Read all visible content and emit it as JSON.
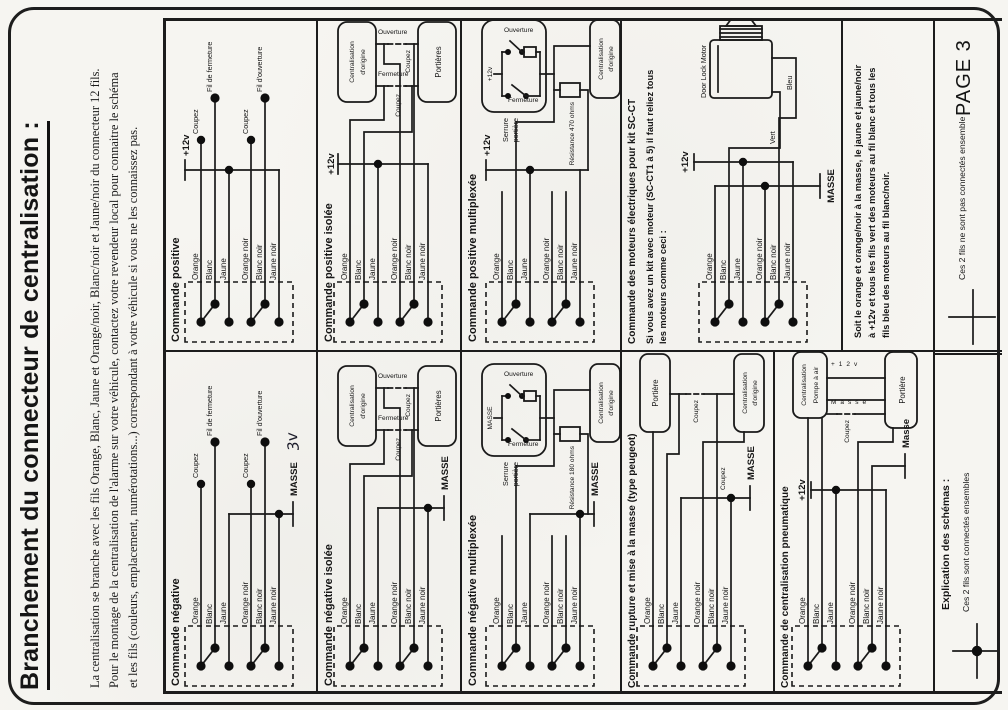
{
  "page": {
    "title": "Branchement du connecteur de centralisation :",
    "intro_lines": [
      "La centralisation se branche avec les fils Orange, Blanc, Jaune et Orange/noir, Blanc/noir et Jaune/noir du connecteur 12 fils.",
      "Pour le montage de la centralisation de l'alarme sur votre véhicule, contactez votre revendeur local pour connaitre le schéma",
      "et les fils (couleurs, emplacement, numérotations...) correspondant à votre véhicule si vous ne les connaissez pas."
    ],
    "page_number": "PAGE 3"
  },
  "wires": {
    "orange": "Orange",
    "blanc": "Blanc",
    "jaune": "Jaune",
    "orange_noir": "Orange noir",
    "blanc_noir": "Blanc noir",
    "jaune_noir": "Jaune noir"
  },
  "labels": {
    "coupez": "Coupez",
    "fil_fermeture": "Fil de fermeture",
    "fil_ouverture": "Fil d'ouverture",
    "plus12v": "+12v",
    "masse_caps": "MASSE",
    "masse": "Masse",
    "handwritten_3v": "3v",
    "ouverture": "Ouverture",
    "fermeture": "Fermeture",
    "centralisation": "Centralisation",
    "dorigine": "d'origine",
    "portieres": "Portières",
    "portiere": "Portière",
    "serrure": "Serrure",
    "portiere_lower": "portière",
    "resistance_470": "Résistance 470 ohms",
    "resistance_180": "Résistance 180 ohms",
    "door_lock_motor": "Door Lock Motor",
    "vert": "Vert",
    "bleu": "Bleu",
    "pompe": "Pompe à air"
  },
  "sections": {
    "positive": {
      "title": "Commande positive"
    },
    "negative": {
      "title": "Commande négative"
    },
    "positive_isolee": {
      "title": "Commande positive isolée"
    },
    "negative_isolee": {
      "title": "Commande négative isolée"
    },
    "positive_multiplexee": {
      "title": "Commande positive multiplexée"
    },
    "negative_multiplexee": {
      "title": "Commande négative multiplexée"
    },
    "sc_ct": {
      "title": "Commande des moteurs électriques pour kit SC-CT",
      "instruction_lines": [
        "Si vous avez un kit avec moteur (SC-CT1 à 5) il faut reliez tous",
        "les moteurs comme ceci :"
      ],
      "note_lines": [
        "Soit le orange et orange/noir à la masse, le jaune et jaune/noir",
        "à +12v et tous les fils vert des moteurs au fil blanc et tous les",
        "fils bleu des moteurs au fil blanc/noir."
      ]
    },
    "rupture": {
      "title": "Commande rupture et mise à la masse (type peugeot)"
    },
    "pneumatique": {
      "title": "Commande de centralisation pneumatique"
    },
    "explication": {
      "title": "Explication des schémas :",
      "connected": "Ces 2 fils sont connectés ensembles",
      "not_connected": "Ces 2 fils ne sont pas connectés ensemble"
    }
  }
}
